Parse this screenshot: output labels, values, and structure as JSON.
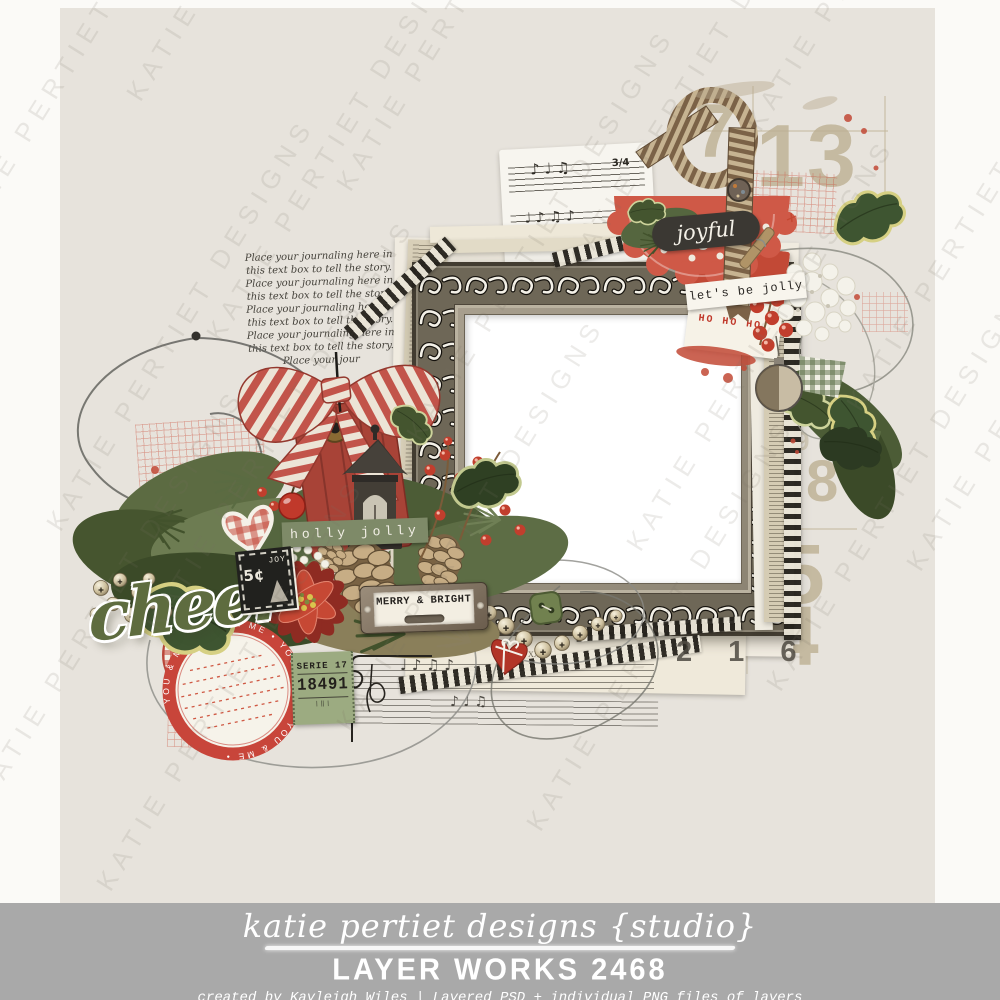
{
  "watermark": {
    "text": "KATIE PERTIET DESIGNS"
  },
  "artwork": {
    "journaling_text": "Place your journaling here in this text box to tell the story. Place your journaling here in this text box to tell the story. Place your journaling here in this text box to tell the story. Place your journaling here in this text box to tell the story. Place your jour",
    "labels": {
      "joyful": "joyful",
      "lets_be_jolly": "let's be jolly",
      "ho_ho_ho": "HO HO HO'",
      "holly_jolly": "holly jolly",
      "merry_bright": "MERRY & BRIGHT",
      "cheer": "cheer",
      "chalk_price": "5¢",
      "chalk_word": "JOY",
      "strip_caption": "jolies by brilliant",
      "ledger_numeral": "XXII",
      "circle_tag_text": "YOU & ME • YOU & ME • YOU & ME • YOU & ME •"
    },
    "ticket": {
      "serie": "SERIE",
      "serie_no": "17",
      "number": "18491"
    },
    "stamped_numbers": {
      "n7": "7",
      "n13": "13",
      "n9": "9",
      "n2": "2",
      "n8": "8",
      "n5": "5",
      "n4": "4",
      "n216": "2 1 6"
    },
    "music": {
      "time_signature": "3/4",
      "notes_top": "♪  ♩  ♫",
      "notes_bottom": "♩ ♪    ♫   ♪"
    }
  },
  "footer": {
    "script_line": "katie pertiet designs {studio}",
    "product_line": "LAYER WORKS 2468",
    "credit_line": "created by Kayleigh Wiles | Layered PSD + individual PNG files of layers"
  },
  "colors": {
    "canvas_cream": "#e7e3dc",
    "footer_gray": "#a9a9a9",
    "accent_red": "#c24936",
    "doily_red": "#cf5947",
    "sage_green": "#7e8a68",
    "leaf_green": "#3e5531",
    "script_green": "#5e6c3f",
    "charcoal": "#3b3833",
    "ticket_green": "#9cab81",
    "stamp_tan": "#bdb093",
    "frame_taupe": "#6e6757"
  }
}
